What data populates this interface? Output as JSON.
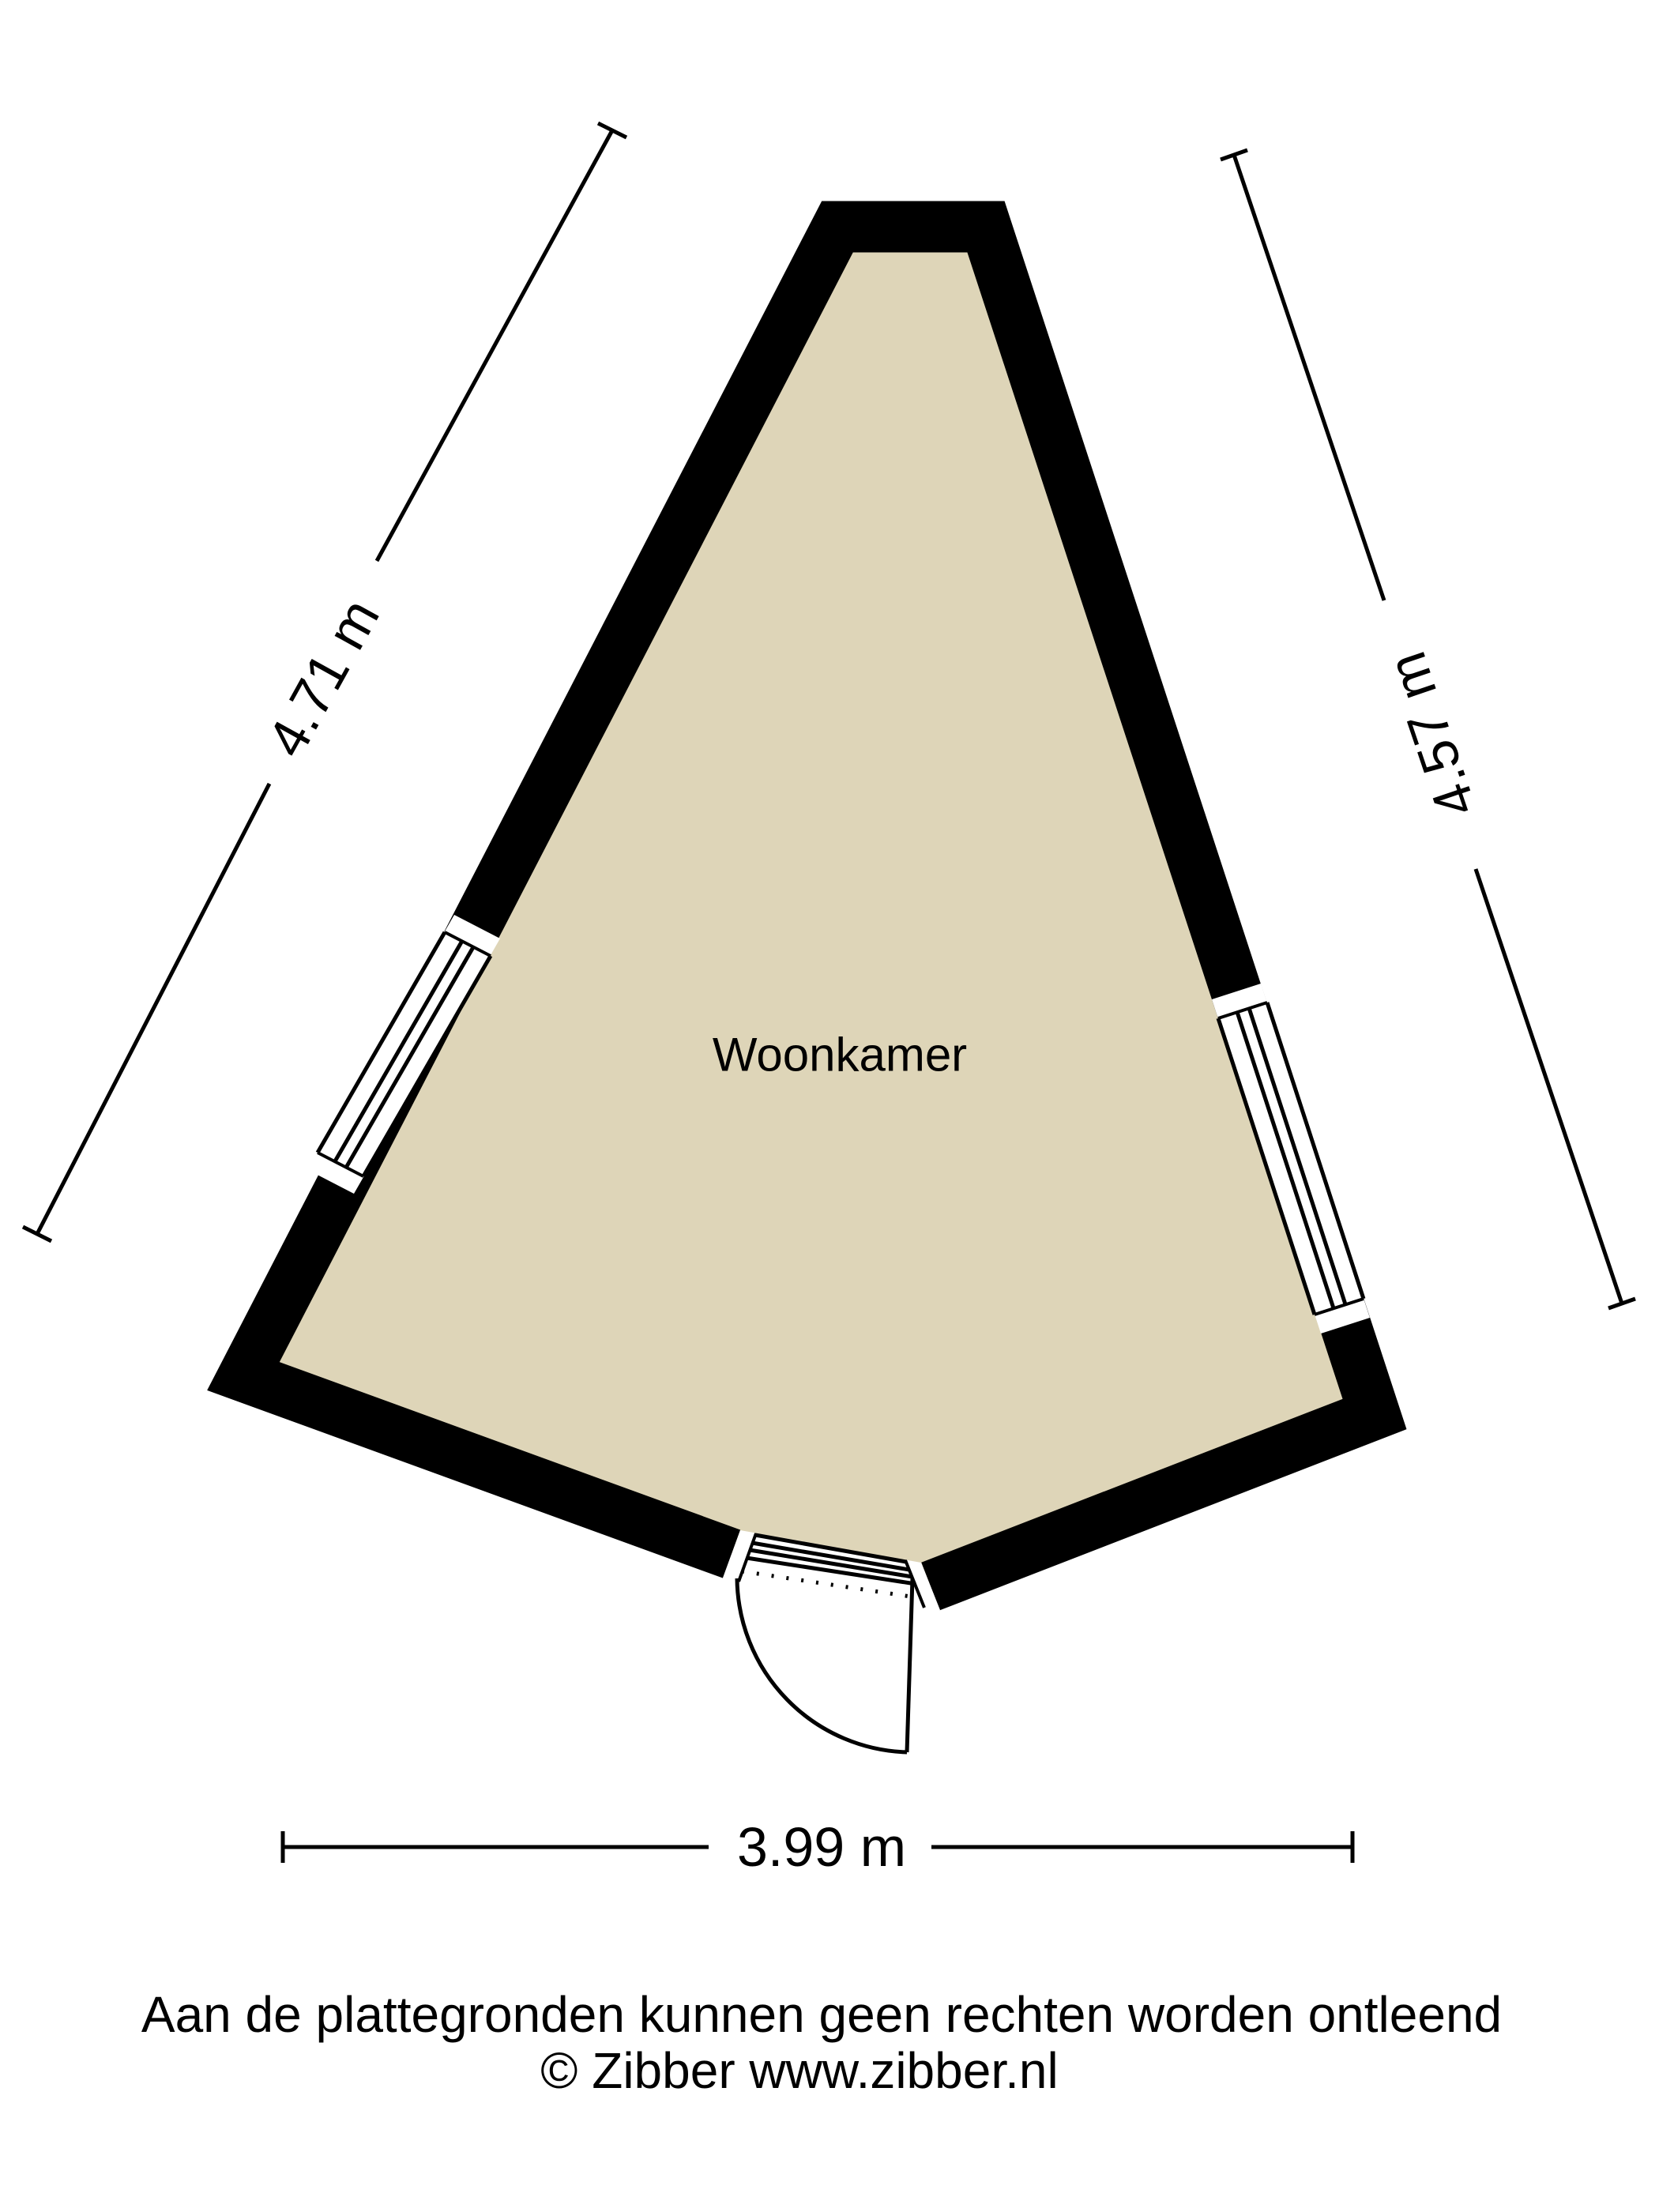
{
  "floorplan": {
    "room": {
      "label": "Woonkamer"
    },
    "dimensions": {
      "left": "4.71 m",
      "right": "4.57 m",
      "bottom": "3.99 m"
    },
    "footer": {
      "disclaimer": "Aan de plattegronden kunnen geen rechten worden ontleend",
      "credit": "© Zibber www.zibber.nl"
    },
    "colors": {
      "floor": "#ded5b8",
      "wall": "#000000",
      "background": "#ffffff"
    }
  }
}
